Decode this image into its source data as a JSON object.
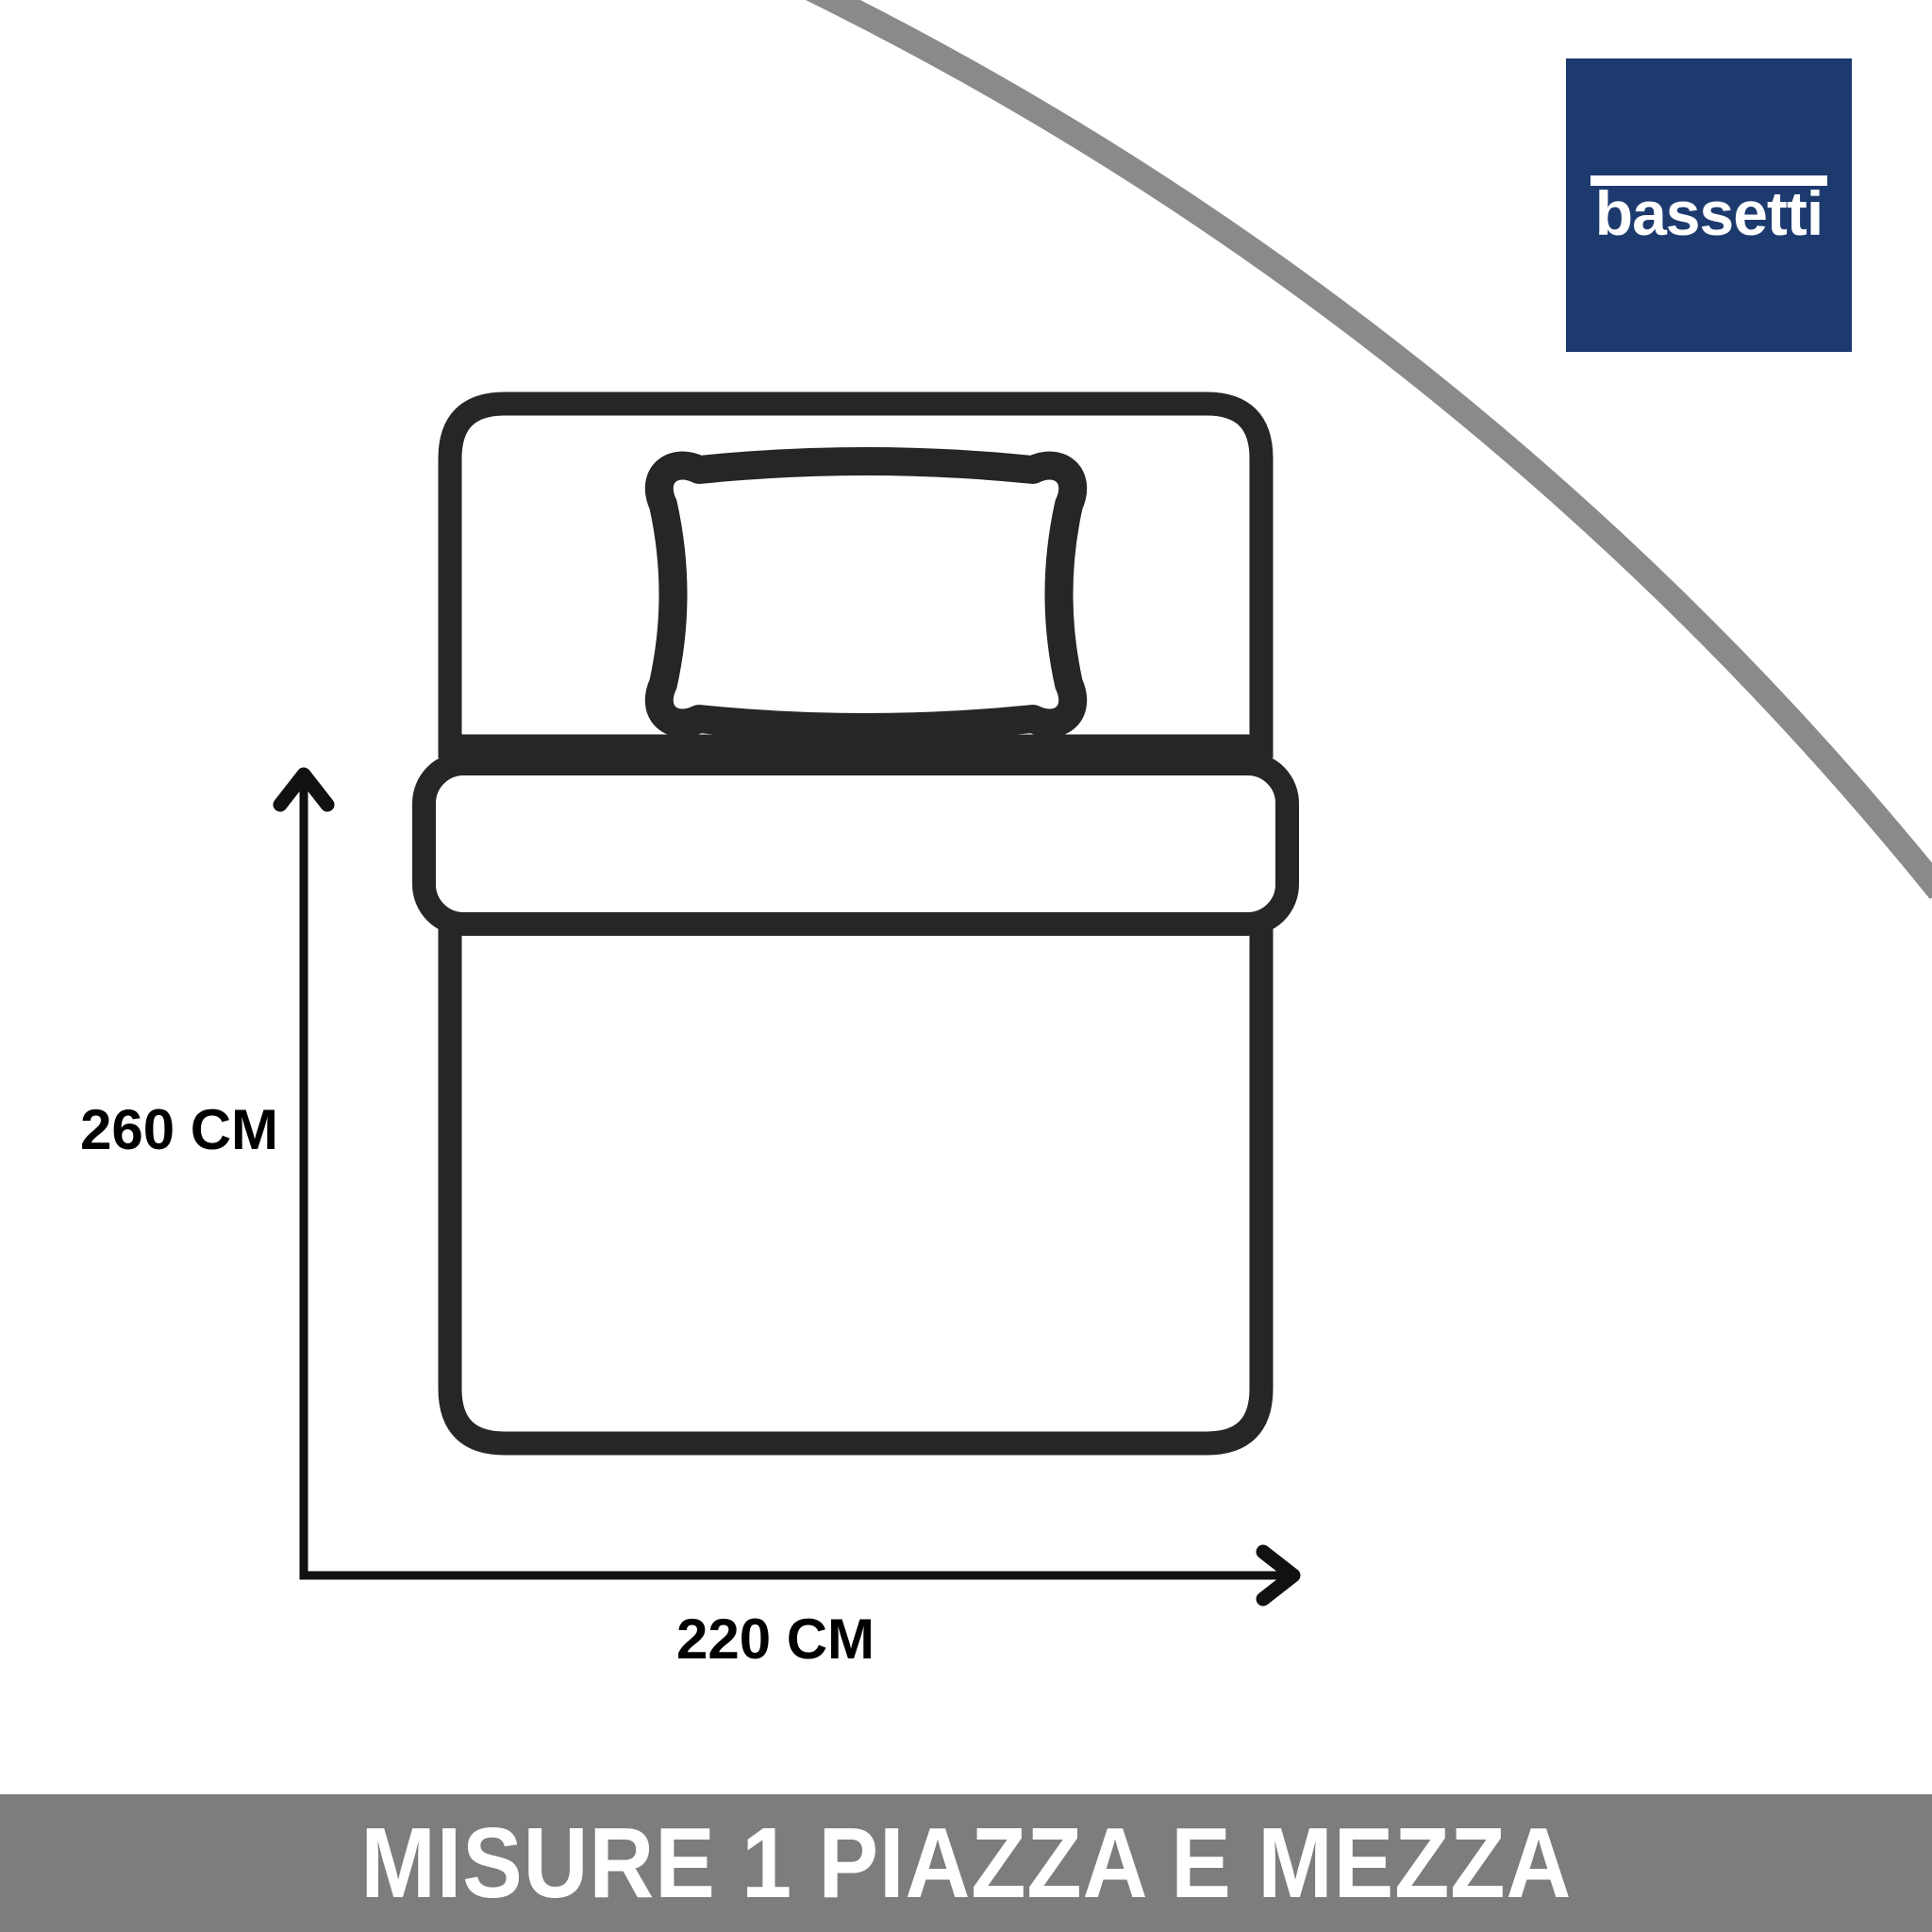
{
  "logo": {
    "text": "bassetti",
    "background_color": "#1d3a6e",
    "text_color": "#ffffff"
  },
  "diagram": {
    "type": "bed-size-top-view",
    "height_label": "260 CM",
    "width_label": "220 CM",
    "label_color": "#000000",
    "bed_outline_color": "#262626",
    "arrow_color": "#111111",
    "curve_color": "#8a8a8a",
    "icons": {
      "bed_icon": "top-view bed outline with fold band (svg shape)",
      "pillow_icon": "pillow outline with puffed corners (svg shape)",
      "up_arrow_icon": "vertical measure arrow (svg chevron)",
      "right_arrow_icon": "horizontal measure arrow (svg chevron)"
    }
  },
  "banner": {
    "text": "MISURE 1 PIAZZA E MEZZA",
    "background_color": "#7d7d7d",
    "text_color": "#ffffff"
  }
}
